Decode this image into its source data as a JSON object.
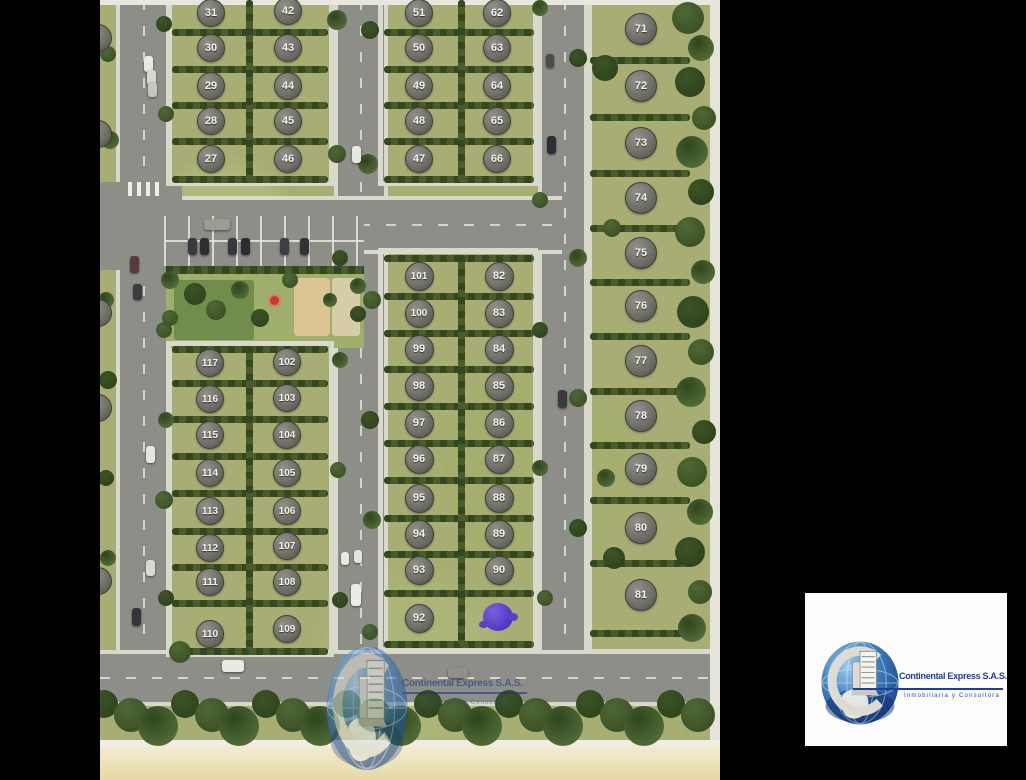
{
  "site_map": {
    "blocks": [
      {
        "name": "block-a",
        "d": 26,
        "columns": [
          {
            "cx": 110,
            "ys": [
              12,
              47,
              85,
              120,
              158
            ],
            "numbers": [
              "31",
              "30",
              "29",
              "28",
              "27"
            ]
          },
          {
            "cx": 187,
            "ys": [
              10,
              47,
              85,
              120,
              158
            ],
            "numbers": [
              "42",
              "43",
              "44",
              "45",
              "46"
            ]
          }
        ]
      },
      {
        "name": "block-b",
        "d": 26,
        "columns": [
          {
            "cx": 318,
            "ys": [
              12,
              47,
              85,
              120,
              158
            ],
            "numbers": [
              "51",
              "50",
              "49",
              "48",
              "47"
            ]
          },
          {
            "cx": 396,
            "ys": [
              12,
              47,
              85,
              120,
              158
            ],
            "numbers": [
              "62",
              "63",
              "64",
              "65",
              "66"
            ]
          }
        ]
      },
      {
        "name": "block-c",
        "d": 30,
        "columns": [
          {
            "cx": 540,
            "ys": [
              28,
              85,
              142,
              197,
              252,
              305,
              360,
              415,
              468,
              527,
              594
            ],
            "numbers": [
              "71",
              "72",
              "73",
              "74",
              "75",
              "76",
              "77",
              "78",
              "79",
              "80",
              "81"
            ]
          }
        ]
      },
      {
        "name": "block-d",
        "d": 27,
        "columns": [
          {
            "cx": 318,
            "ys": [
              275,
              312,
              348,
              385,
              422,
              458,
              497,
              533,
              569,
              617
            ],
            "numbers": [
              "101",
              "100",
              "99",
              "98",
              "97",
              "96",
              "95",
              "94",
              "93",
              "92"
            ]
          },
          {
            "cx": 398,
            "ys": [
              275,
              312,
              348,
              385,
              422,
              458,
              497,
              533,
              569
            ],
            "numbers": [
              "82",
              "83",
              "84",
              "85",
              "86",
              "87",
              "88",
              "89",
              "90"
            ]
          }
        ]
      },
      {
        "name": "block-e",
        "d": 26,
        "columns": [
          {
            "cx": 109,
            "ys": [
              362,
              398,
              434,
              472,
              510,
              547,
              581,
              633
            ],
            "numbers": [
              "117",
              "116",
              "115",
              "114",
              "113",
              "112",
              "111",
              "110"
            ]
          },
          {
            "cx": 186,
            "ys": [
              361,
              397,
              434,
              472,
              510,
              545,
              581,
              628
            ],
            "numbers": [
              "102",
              "103",
              "104",
              "105",
              "106",
              "107",
              "108",
              "109"
            ]
          }
        ]
      }
    ],
    "sold_marker": {
      "x": 398,
      "y": 617,
      "color": "#5b3fc8"
    },
    "edge_marker_ys": [
      37,
      133,
      312,
      407,
      580
    ]
  },
  "watermark": {
    "title": "Continental Express S.A.S.",
    "subtitle": "Inmobiliaria y Consultora"
  },
  "logo": {
    "title": "Continental Express S.A.S.",
    "subtitle": "Inmobiliaria y Consultora"
  },
  "colors": {
    "sold_purple": "#5b3fc8",
    "logo_blue": "#1d3e9e",
    "hedge_green": "#3c4f23",
    "asphalt": "#8e8e88"
  }
}
